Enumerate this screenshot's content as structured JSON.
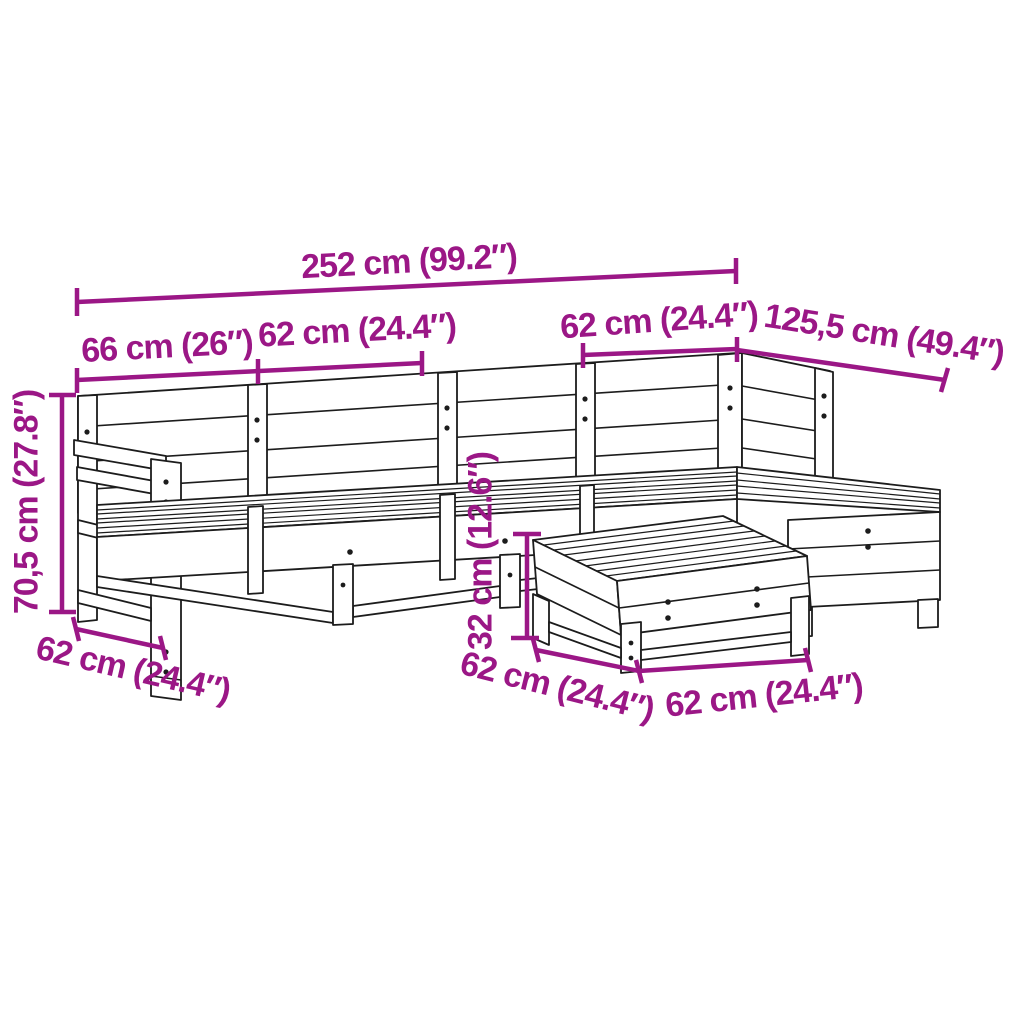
{
  "diagram": {
    "type": "product-dimension-drawing",
    "subject": "6-piece wooden garden lounge sofa set with corner section, ottoman and footstool",
    "style": {
      "accent_color": "#9B1786",
      "line_color": "#1C1C1C",
      "background_color": "#FFFFFF"
    },
    "dimensions": {
      "overall_width": {
        "label": "252 cm (99.2″)"
      },
      "left_section_width": {
        "label": "66 cm (26″)"
      },
      "middle_section_width": {
        "label": "62 cm (24.4″)"
      },
      "corner_section_width": {
        "label": "62 cm (24.4″)"
      },
      "chaise_length": {
        "label": "125,5 cm (49.4″)"
      },
      "total_height": {
        "label": "70,5 cm (27.8″)"
      },
      "seat_depth_left": {
        "label": "62 cm (24.4″)"
      },
      "footstool_height": {
        "label": "32 cm (12.6″)"
      },
      "footstool_depth": {
        "label": "62 cm (24.4″)"
      },
      "footstool_width": {
        "label": "62 cm (24.4″)"
      }
    }
  }
}
